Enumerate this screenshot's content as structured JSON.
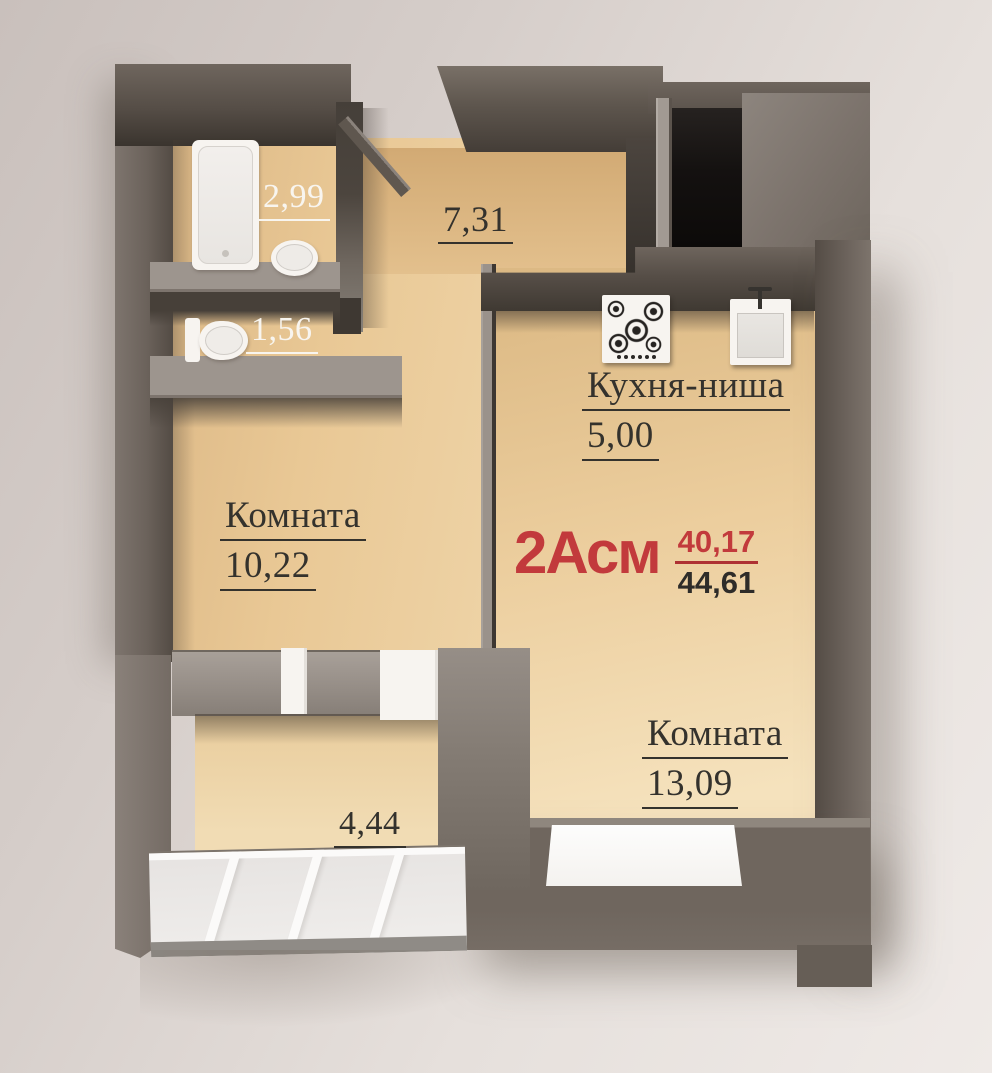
{
  "apartment_label": {
    "type": "2Асм",
    "upper_area": "40,17",
    "lower_area": "44,61"
  },
  "rooms": {
    "bathroom": {
      "area": "2,99"
    },
    "wc": {
      "area": "1,56"
    },
    "hallway": {
      "area": "7,31"
    },
    "kitchen_niche": {
      "name": "Кухня-ниша",
      "area": "5,00"
    },
    "room_left": {
      "name": "Комната",
      "area": "10,22"
    },
    "room_right": {
      "name": "Комната",
      "area": "13,09"
    },
    "balcony": {
      "area": "4,44"
    }
  },
  "fixtures": {
    "bathtub": "bathtub",
    "wash_basin": "wash-basin",
    "toilet": "toilet",
    "gas_hob": "gas-hob",
    "kitchen_sink": "kitchen-sink",
    "entrance_door": "entrance-door-leaf",
    "balcony_doors": "balcony-door-units",
    "window": "window",
    "balcony_glazing": "balcony-glazing"
  },
  "palette": {
    "background": "#d8d1cd",
    "wall_top": "#948c85",
    "wall_front": "#6e655e",
    "wall_dark": "#453f39",
    "niche_black": "#141110",
    "floor_beige": "#e9c995",
    "fixture_white": "#f7f4f0",
    "label_dark": "#34322d",
    "label_white": "#f8f5ef",
    "accent_red": "#c23a3c"
  }
}
